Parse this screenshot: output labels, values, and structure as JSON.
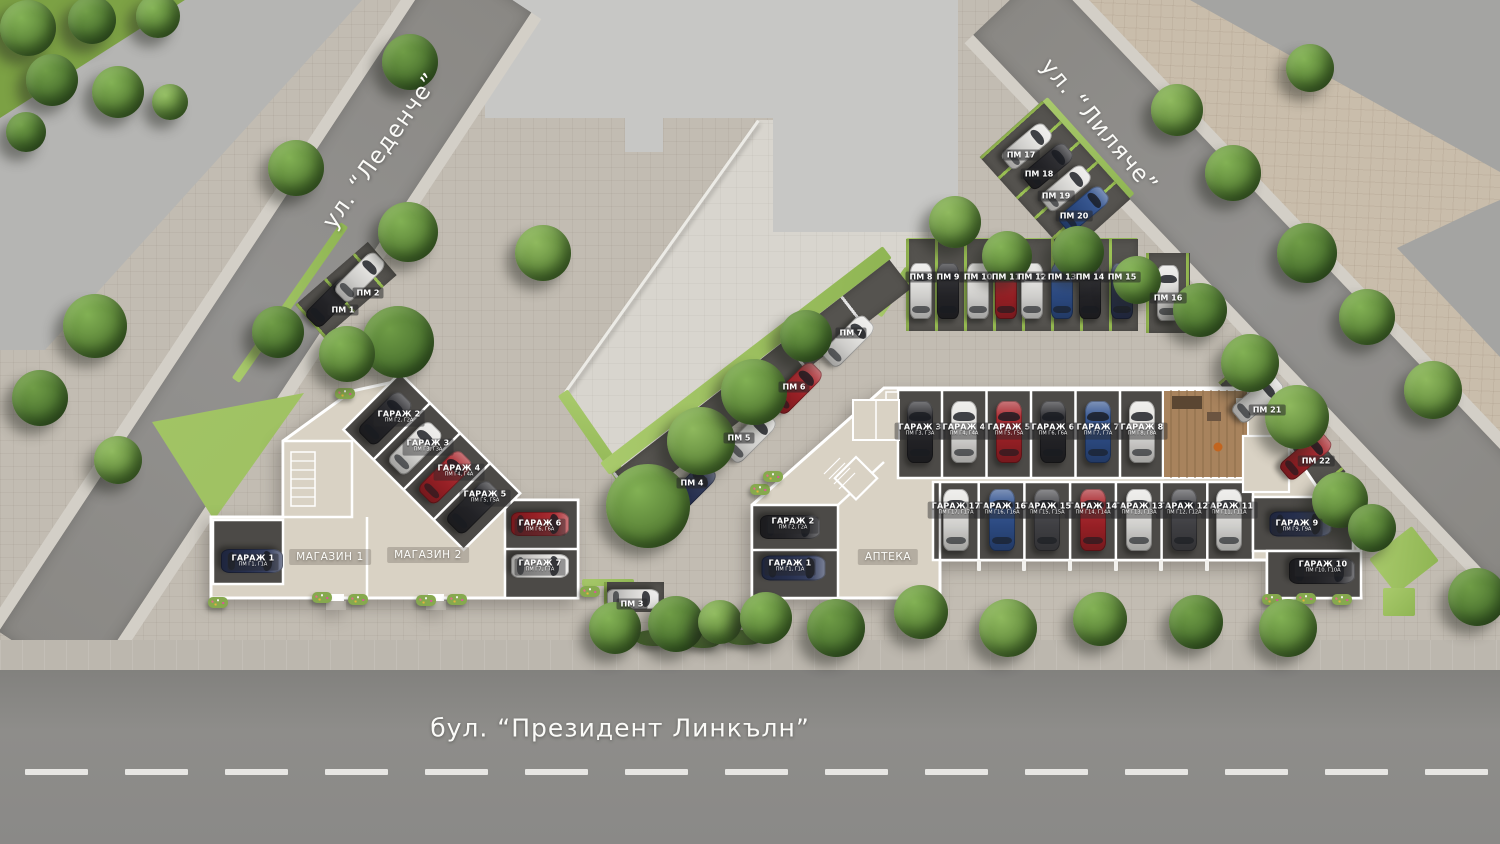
{
  "streets": {
    "left": "ул. “Леденче”",
    "right": "ул. “Лиляче”",
    "boulevard": "бул. “Президент Линкълн”"
  },
  "left_building": {
    "shops": [
      {
        "label": "МАГАЗИН 1"
      },
      {
        "label": "МАГАЗИН 2"
      }
    ],
    "garages": [
      {
        "label": "ГАРАЖ 1",
        "sub": "ПМ Г1, Г1А"
      },
      {
        "label": "ГАРАЖ 2",
        "sub": "ПМ Г2, Г2А"
      },
      {
        "label": "ГАРАЖ 3",
        "sub": "ПМ Г3, Г3А"
      },
      {
        "label": "ГАРАЖ 4",
        "sub": "ПМ Г4, Г4А"
      },
      {
        "label": "ГАРАЖ 5",
        "sub": "ПМ Г5, Г5А"
      },
      {
        "label": "ГАРАЖ 6",
        "sub": "ПМ Г6, Г6А"
      },
      {
        "label": "ГАРАЖ 7",
        "sub": "ПМ Г7, Г7А"
      }
    ]
  },
  "right_building": {
    "pharmacy": {
      "label": "АПТЕКА"
    },
    "garages": [
      {
        "label": "ГАРАЖ 1",
        "sub": "ПМ Г1, Г1А"
      },
      {
        "label": "ГАРАЖ 2",
        "sub": "ПМ Г2, Г2А"
      },
      {
        "label": "ГАРАЖ 3",
        "sub": "ПМ Г3, Г3А"
      },
      {
        "label": "ГАРАЖ 4",
        "sub": "ПМ Г4, Г4А"
      },
      {
        "label": "ГАРАЖ 5",
        "sub": "ПМ Г5, Г5А"
      },
      {
        "label": "ГАРАЖ 6",
        "sub": "ПМ Г6, Г6А"
      },
      {
        "label": "ГАРАЖ 7",
        "sub": "ПМ Г7, Г7А"
      },
      {
        "label": "ГАРАЖ 8",
        "sub": "ПМ Г8, Г8А"
      },
      {
        "label": "ГАРАЖ 9",
        "sub": "ПМ Г9, Г9А"
      },
      {
        "label": "ГАРАЖ 10",
        "sub": "ПМ Г10, Г10А"
      },
      {
        "label": "ГАРАЖ 11",
        "sub": "ПМ Г11, Г11А"
      },
      {
        "label": "ГАРАЖ 12",
        "sub": "ПМ Г12, Г12А"
      },
      {
        "label": "ГАРАЖ 13",
        "sub": "ПМ Г13, Г13А"
      },
      {
        "label": "ГАРАЖ 14",
        "sub": "ПМ Г14, Г14А"
      },
      {
        "label": "ГАРАЖ 15",
        "sub": "ПМ Г15, Г15А"
      },
      {
        "label": "ГАРАЖ 16",
        "sub": "ПМ Г16, Г16А"
      },
      {
        "label": "ГАРАЖ 17",
        "sub": "ПМ Г17, Г17А"
      }
    ]
  },
  "parking_spots": [
    "ПМ 1",
    "ПМ 2",
    "ПМ 3",
    "ПМ 4",
    "ПМ 5",
    "ПМ 6",
    "ПМ 7",
    "ПМ 8",
    "ПМ 9",
    "ПМ 10",
    "ПМ 11",
    "ПМ 12",
    "ПМ 13",
    "ПМ 14",
    "ПМ 15",
    "ПМ 16",
    "ПМ 17",
    "ПМ 18",
    "ПМ 19",
    "ПМ 20",
    "ПМ 21",
    "ПМ 22"
  ],
  "palette": {
    "car_white": "#e6e5e2",
    "car_black": "#26262a",
    "car_red": "#a72329",
    "car_blue": "#30518e",
    "car_navy": "#2b3557",
    "car_gray": "#46464a",
    "grass": "#8fb553",
    "asphalt": "#8e8c88",
    "walls": "#ffffff",
    "rooms": "#d9d2c4"
  }
}
